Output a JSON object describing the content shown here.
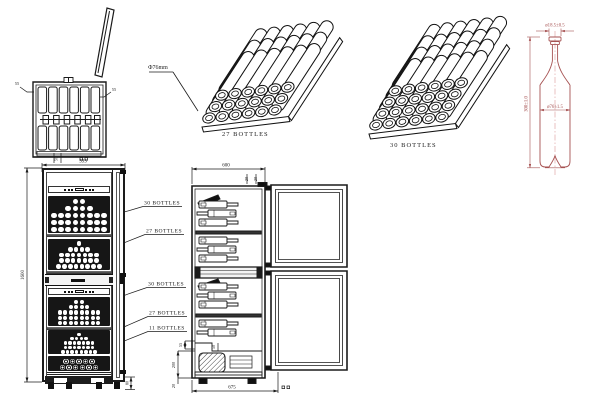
{
  "drawing_title": "dual-zone wine cabinet technical drawing",
  "top_view": {
    "wall_dim_left": "55",
    "wall_dim_right": "55"
  },
  "diameter_note": "Φ76mm",
  "iso_racks": [
    {
      "label": "27 BOTTLES",
      "tiers": 3,
      "cols": 6
    },
    {
      "label": "30 BOTTLES",
      "tiers": 4,
      "cols": 6
    }
  ],
  "bottle": {
    "neck_dim": "ø18.5±0.5",
    "height_dim": "300±1.0",
    "body_dim": "ø76±1.5",
    "line_color": "#a65252"
  },
  "front_view": {
    "width_dim": "595",
    "top_dim": "50",
    "height_dim": "1600",
    "base_dim": "80",
    "racks": [
      {
        "label": "30 BOTTLES",
        "rows": [
          2,
          4,
          8,
          8,
          8
        ],
        "style": "plain"
      },
      {
        "label": "27 BOTTLES",
        "rows": [
          1,
          4,
          7,
          7,
          8
        ],
        "style": "plain"
      },
      {
        "label": "30 BOTTLES",
        "rows": [
          2,
          4,
          8,
          8,
          8
        ],
        "style": "plain"
      },
      {
        "label": "27 BOTTLES",
        "rows": [
          1,
          4,
          7,
          7,
          8
        ],
        "style": "plain"
      },
      {
        "label": "11 BOTTLES",
        "rows": [
          5,
          6
        ],
        "style": "rings"
      }
    ]
  },
  "side_view": {
    "depth_dim": "600",
    "door_top_dims": [
      "20",
      "20"
    ],
    "liner_dim": "55",
    "step_dim": "50",
    "compressor_zone_dim": "200",
    "foot_dim": "20",
    "total_depth_dim": "675"
  }
}
